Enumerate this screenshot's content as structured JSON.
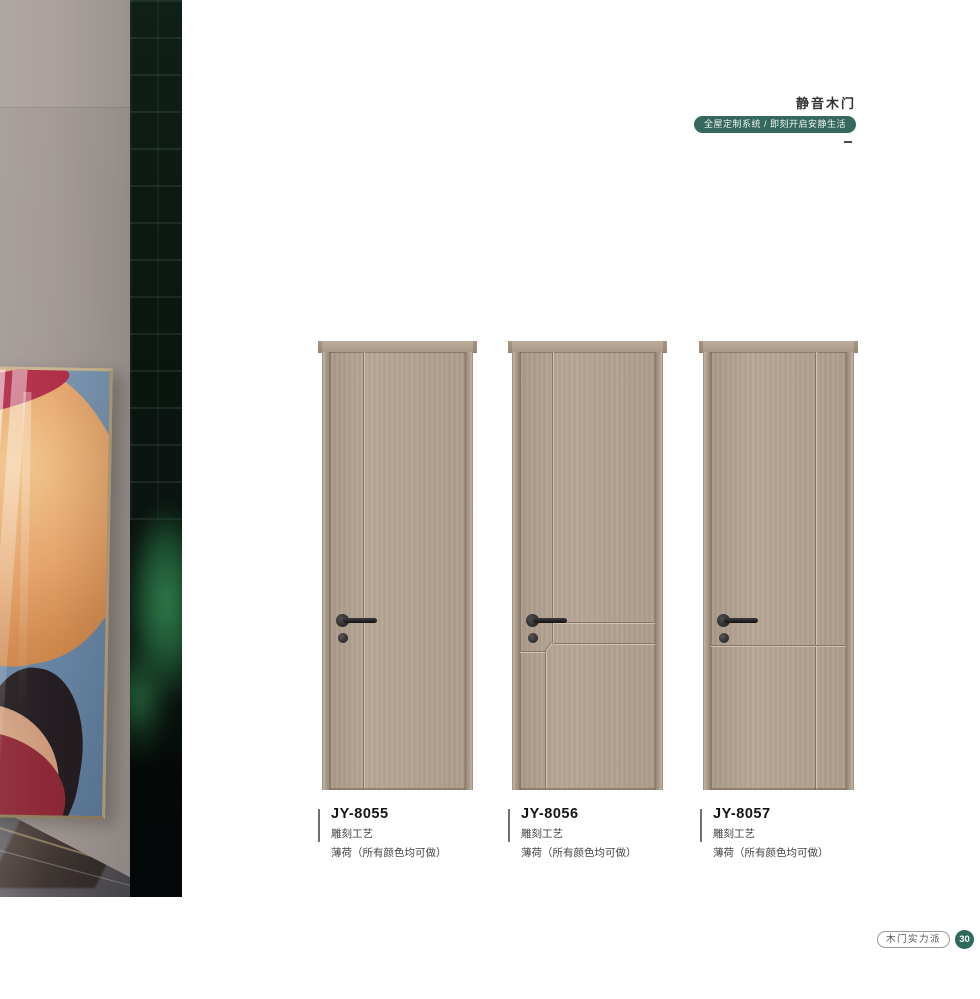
{
  "header": {
    "title": "静音木门",
    "badge": "全屋定制系统 / 即刻开启安静生活"
  },
  "sidebar": {
    "line1": "CUSTOMIZED",
    "line2": "DOOR",
    "new_en": "NEW",
    "new_cn": "新品色系",
    "sub1": "UNPAINTED",
    "sub2": "WOODEN DOOR"
  },
  "products": [
    {
      "model": "JY-8055",
      "craft": "雕刻工艺",
      "note": "薄荷（所有颜色均可做）"
    },
    {
      "model": "JY-8056",
      "craft": "雕刻工艺",
      "note": "薄荷（所有颜色均可做）"
    },
    {
      "model": "JY-8057",
      "craft": "雕刻工艺",
      "note": "薄荷（所有颜色均可做）"
    }
  ],
  "footer": {
    "brand": "木门实力派",
    "page": "30"
  },
  "colors": {
    "accent_teal": "#35695f",
    "door_wood": "#b4a391",
    "banner_dark": "#0b1410",
    "sofa_green": "#2e7a49"
  }
}
